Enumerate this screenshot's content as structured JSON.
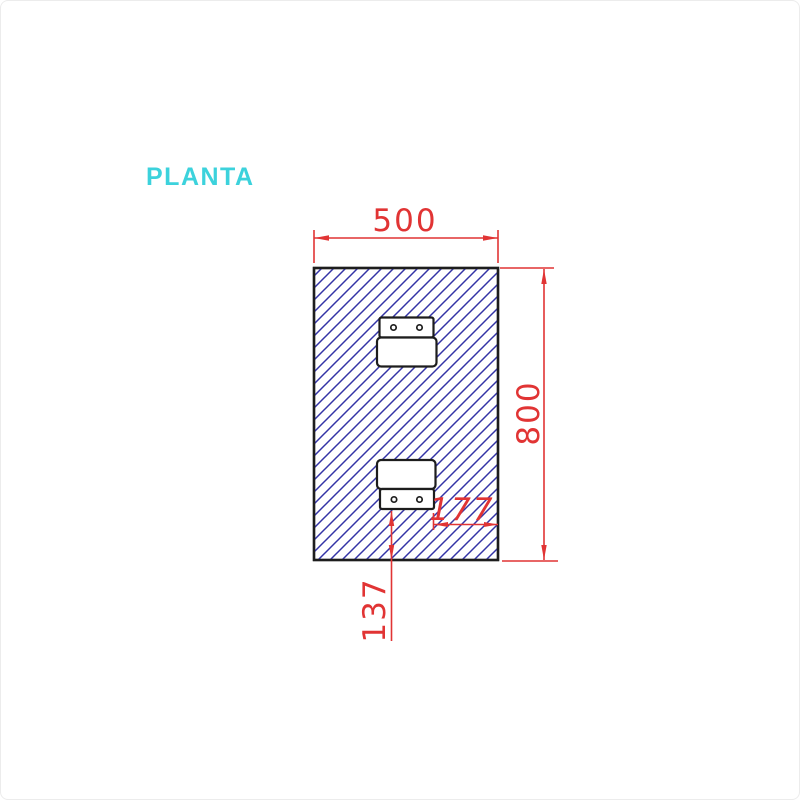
{
  "page": {
    "background": "#ffffff",
    "frame_border_color": "#ececec"
  },
  "drawing": {
    "title": "PLANTA",
    "type": "technical-plan-view",
    "colors": {
      "outline": "#1d1d1d",
      "hatch": "#3434a6",
      "dim": "#e13434",
      "title": "#3cd2dc"
    },
    "dimensions": {
      "width": "500",
      "height": "800",
      "plate_offset_right": "177",
      "plate_offset_bottom": "137"
    }
  }
}
